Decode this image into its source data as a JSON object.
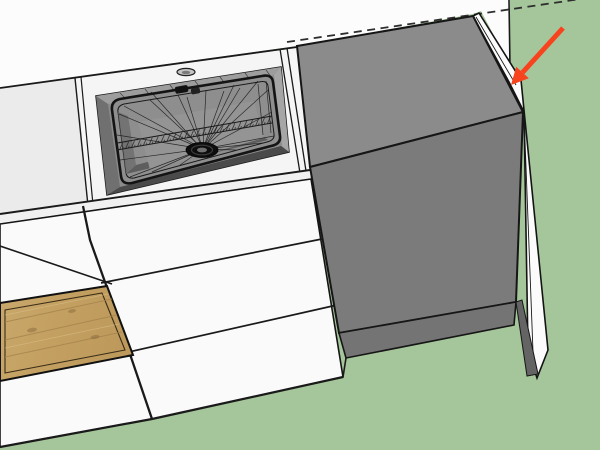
{
  "viewport": {
    "type": "3d-model-viewport",
    "background_sky": "#fcfcfc",
    "background_ground": "#a5c69a"
  },
  "colors": {
    "outline": "#1a1a1a",
    "counter_left": "#ebebeb",
    "counter_sink": "#f5f5f5",
    "counter_edge_band": "#f0f0f0",
    "cabinet_front_white": "#fafafa",
    "end_panel_white": "#fbfbfb",
    "cabinet_top_gray": "#8b8b8b",
    "cabinet_front_gray": "#7b7b7b",
    "cabinet_toe_gray": "#747474",
    "panel_shadow_gray": "#646464",
    "sink_basin": "#8e8e8e",
    "sink_cutout": "#8b8b8b",
    "sink_front_shadow": "#4a4a4a",
    "sink_floor": "#949494",
    "drain_dark": "#0d0d0d",
    "faucet_hole": "#c4c4c4",
    "wood_base": "#c7a468",
    "wood_grain_dark": "#a6834c",
    "wood_grain_light": "#dcc08a"
  },
  "guides": {
    "dashed_line": {
      "d": "M287,42 L601,-4",
      "dash": "8 5.5",
      "color": "#2e2e2e"
    }
  },
  "annotation": {
    "arrow": {
      "color": "#f8431f",
      "shaft_d": "M563,28 L522.5,72.5",
      "head_points": "511,85 528.8,78.2 516.2,66.8",
      "points_at": "top edge of white end panel"
    }
  },
  "model_objects": {
    "ground": "ground-plane",
    "wall": "back-wall",
    "counter_left": "left-countertop",
    "counter_sink": "sink-countertop",
    "sink": "kitchen-sink",
    "faucet_hole": "faucet-hole",
    "drain": "sink-drain",
    "drawer_stack_left": "left-drawer-stack",
    "wood_front": "wood-drawer-front",
    "drawer_stack_sink": "sink-drawer-stack",
    "gray_cabinet": "tall-gray-cabinet",
    "end_panel": "white-end-panel"
  }
}
